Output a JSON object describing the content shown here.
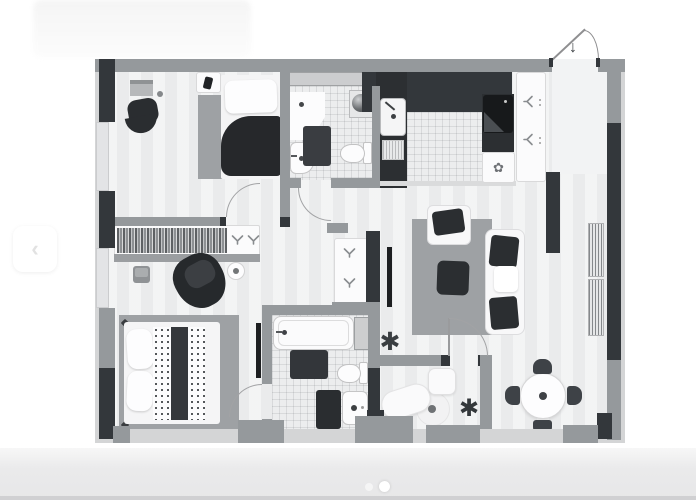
{
  "carousel": {
    "prev_button_glyph": "‹",
    "dots": [
      {
        "state": "inactive"
      },
      {
        "state": "active"
      }
    ]
  },
  "icons": {
    "prev_chevron": "‹",
    "entry_arrow": "↓",
    "plant": "✱",
    "gear_flower": "✿"
  },
  "palette": {
    "wall_dark": "#33373b",
    "wall_gray": "#95999c",
    "wall_light": "#d4d5d6",
    "floor": "#edeeef",
    "tile_floor": "#ecedee",
    "rug_gray": "#9ea1a4",
    "furniture_dark": "#2b2e31",
    "furniture_white": "#fbfbfc",
    "page_background": "#ffffff",
    "footer_band": "#e9e9ea"
  },
  "floorplan": {
    "type": "apartment-floor-plan",
    "style": "grayscale-top-view",
    "entrance": "top-right-door-with-down-arrow",
    "rooms": [
      {
        "name": "bedroom-top-left",
        "furniture": [
          "desk",
          "office-chair",
          "single-bed",
          "nightstand",
          "rug"
        ]
      },
      {
        "name": "bathroom-top",
        "furniture": [
          "corner-sink",
          "bidet",
          "toilet",
          "washbasin",
          "bath-mat"
        ]
      },
      {
        "name": "kitchen",
        "furniture": [
          "dark-counter",
          "sink",
          "stove",
          "cabinet-with-gear"
        ]
      },
      {
        "name": "entry-hall",
        "furniture": [
          "wardrobe",
          "coat-hangers"
        ]
      },
      {
        "name": "hallway",
        "furniture": [
          "wardrobe-with-clothes",
          "hangers",
          "armchair",
          "stool",
          "side-table"
        ]
      },
      {
        "name": "living-room",
        "furniture": [
          "sofa",
          "armchair",
          "coffee-table",
          "tv",
          "rug",
          "radiators",
          "plant",
          "cabinet-with-hangers"
        ]
      },
      {
        "name": "dining-area",
        "furniture": [
          "round-table",
          "four-chairs"
        ]
      },
      {
        "name": "bedroom-bottom-left",
        "furniture": [
          "double-bed",
          "pillows",
          "rug",
          "tv"
        ]
      },
      {
        "name": "bathroom-bottom",
        "furniture": [
          "bathtub",
          "toilet",
          "sink",
          "bath-mats",
          "shelf-niche"
        ]
      },
      {
        "name": "study",
        "furniture": [
          "desk",
          "chaise-lounge",
          "round-rug",
          "plant"
        ]
      }
    ]
  }
}
